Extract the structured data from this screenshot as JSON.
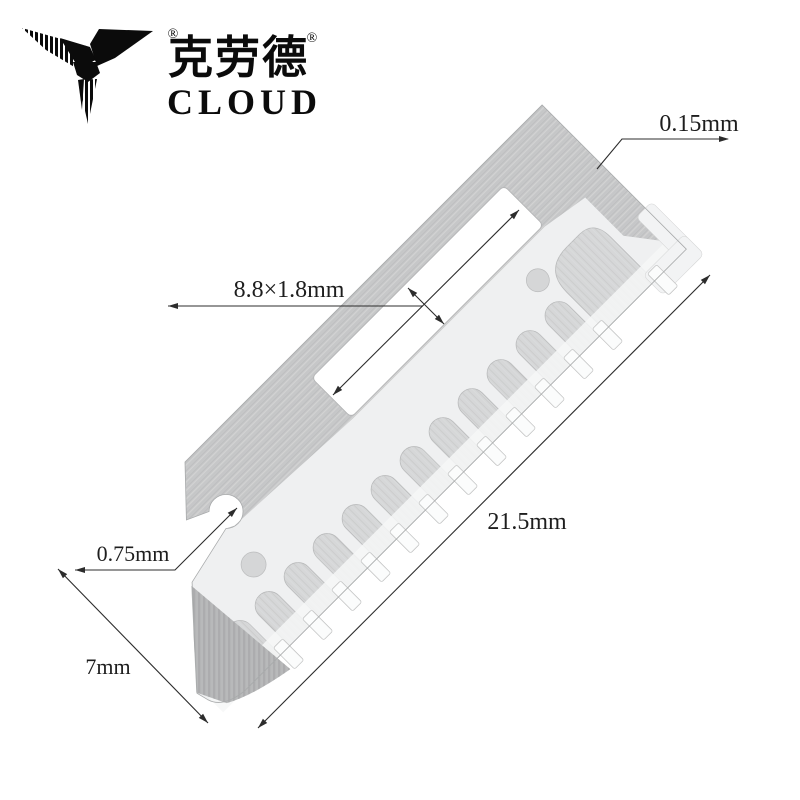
{
  "logo": {
    "zh": "克劳德",
    "en": "CLOUD",
    "registered_mark_1": "®",
    "registered_mark_2": "®",
    "bird_icon": "swallow-mark"
  },
  "dimensions": {
    "thickness": "0.15mm",
    "slot": "8.8×1.8mm",
    "length": "21.5mm",
    "notch": "0.75mm",
    "width": "7mm"
  },
  "colors": {
    "background": "#ffffff",
    "blade_face": "#eff0f1",
    "blade_bevel_gray": "#c7c8c9",
    "arch_slot_gray": "#d6d7d8",
    "dark_corner_bevel": "#b4b5b6",
    "bottom_band": "#f6f7f7",
    "dimension_line": "#2c2c2c",
    "text": "#1e1e1e",
    "logo_black": "#0b0b0b"
  }
}
